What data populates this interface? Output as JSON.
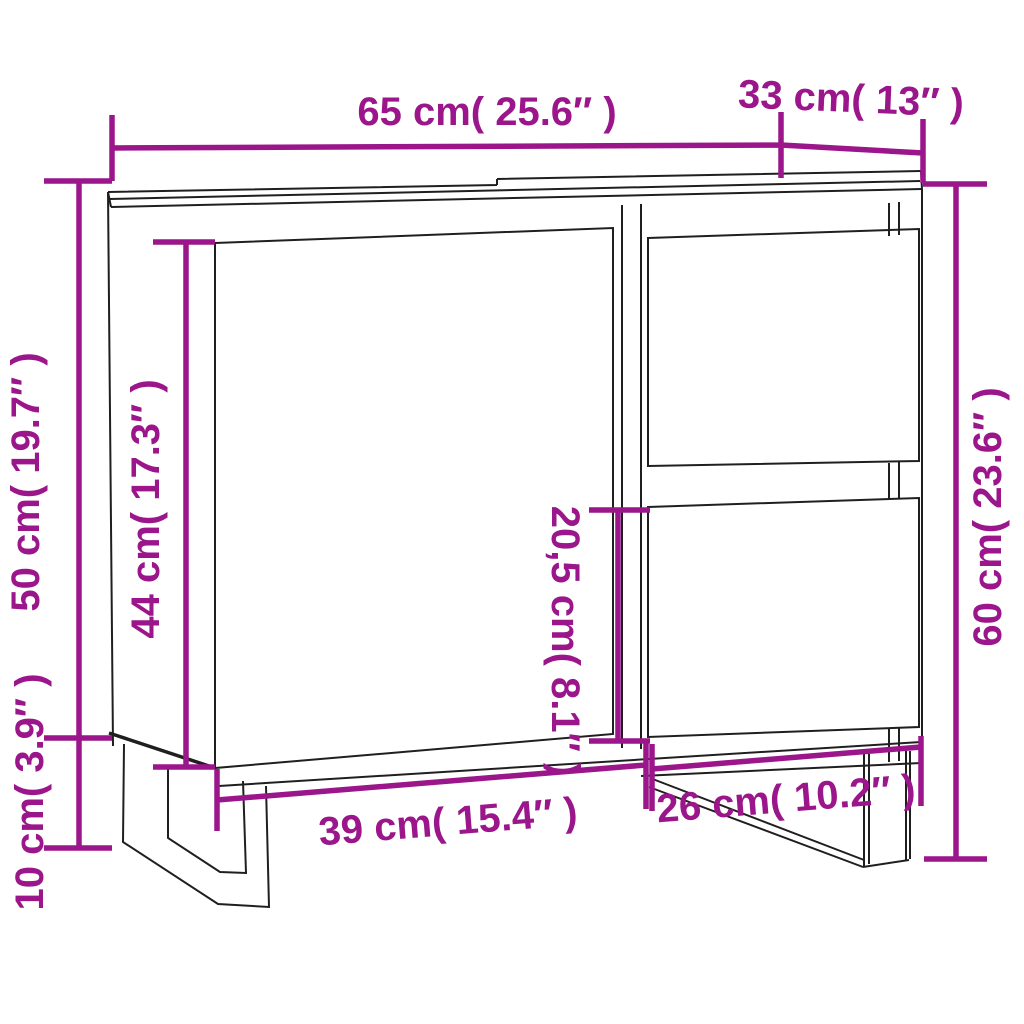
{
  "colors": {
    "dimension_accent": "#9B158B",
    "line_art": "#1f1f1f",
    "background": "#ffffff"
  },
  "diagram": {
    "type": "product-dimension-diagram",
    "dimensions": [
      {
        "id": "top-width",
        "label": "65 cm( 25.6″ )"
      },
      {
        "id": "top-depth",
        "label": "33 cm( 13″ )"
      },
      {
        "id": "left-height-upper",
        "label": "50 cm( 19.7″ )"
      },
      {
        "id": "door-height",
        "label": "44 cm( 17.3″ )"
      },
      {
        "id": "drawer-height",
        "label": "20,5 cm( 8.1″ )"
      },
      {
        "id": "right-height",
        "label": "60 cm( 23.6″ )"
      },
      {
        "id": "bottom-width-left",
        "label": "39 cm( 15.4″ )"
      },
      {
        "id": "bottom-width-right",
        "label": "26 cm( 10.2″ )"
      },
      {
        "id": "leg-height",
        "label": "10 cm( 3.9″ )"
      }
    ]
  }
}
